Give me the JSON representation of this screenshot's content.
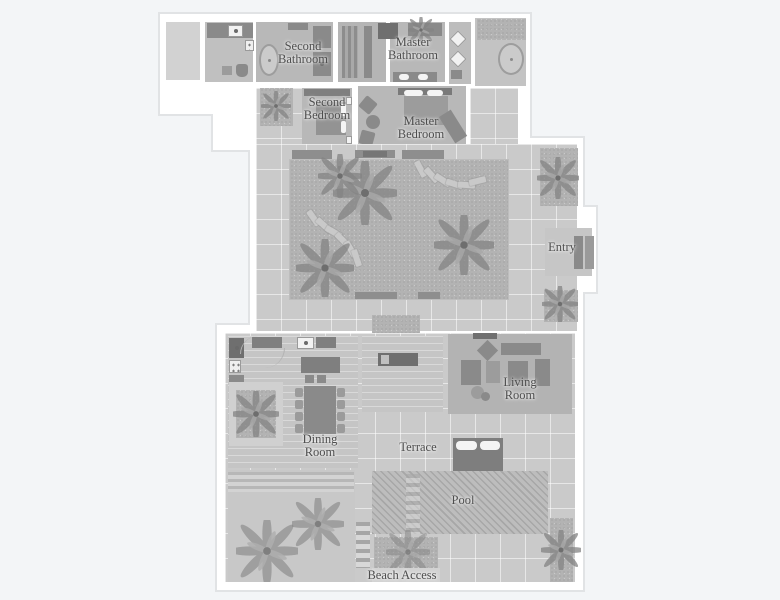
{
  "type": "villa-floor-plan",
  "colors": {
    "background": "#f3f5f7",
    "walls": "#ffffff",
    "outline": "#e1e3e5",
    "room_floor": "#b8b8b8",
    "walkway_tiles": "#cacaca",
    "gravel_garden": "#b3b3b3",
    "furniture": "#8a8a8a",
    "furniture_dark": "#6f6f6f",
    "pool_water": "#b0b0b0",
    "label_text": "#4d4d4d"
  },
  "rooms": {
    "second_bathroom": {
      "line1": "Second",
      "line2": "Bathroom"
    },
    "master_bathroom": {
      "line1": "Master",
      "line2": "Bathroom"
    },
    "second_bedroom": {
      "line1": "Second",
      "line2": "Bedroom"
    },
    "master_bedroom": {
      "line1": "Master",
      "line2": "Bedroom"
    },
    "entry": {
      "line1": "Entry"
    },
    "living_room": {
      "line1": "Living",
      "line2": "Room"
    },
    "dining_room": {
      "line1": "Dining",
      "line2": "Room"
    },
    "terrace": {
      "line1": "Terrace"
    },
    "pool": {
      "line1": "Pool"
    },
    "beach_access": {
      "line1": "Beach Access"
    }
  }
}
